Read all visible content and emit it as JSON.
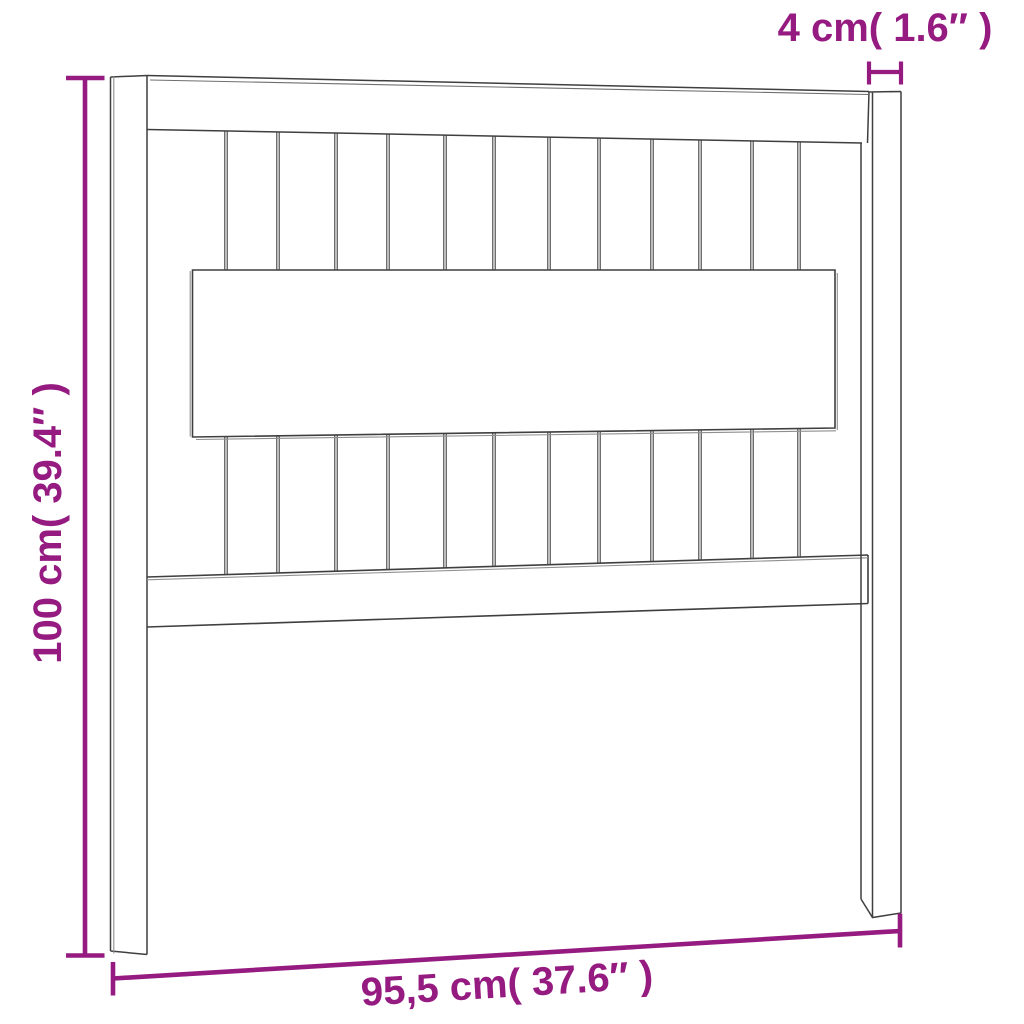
{
  "diagram": {
    "type": "product-dimension-diagram",
    "subject": "slatted wooden headboard, front view",
    "background_color": "#ffffff",
    "line_color": "#3f3f3f",
    "dimension_color": "#951b81",
    "dimensions": {
      "post_width": {
        "label": "4 cm( 1.6″ )",
        "value_cm": "4",
        "value_in": "1.6″",
        "position": "top-right"
      },
      "height": {
        "label": "100 cm( 39.4″ )",
        "value_cm": "100",
        "value_in": "39.4″",
        "position": "left"
      },
      "width": {
        "label": "95,5 cm( 37.6″ )",
        "value_cm": "95,5",
        "value_in": "37.6″",
        "position": "bottom"
      }
    }
  }
}
